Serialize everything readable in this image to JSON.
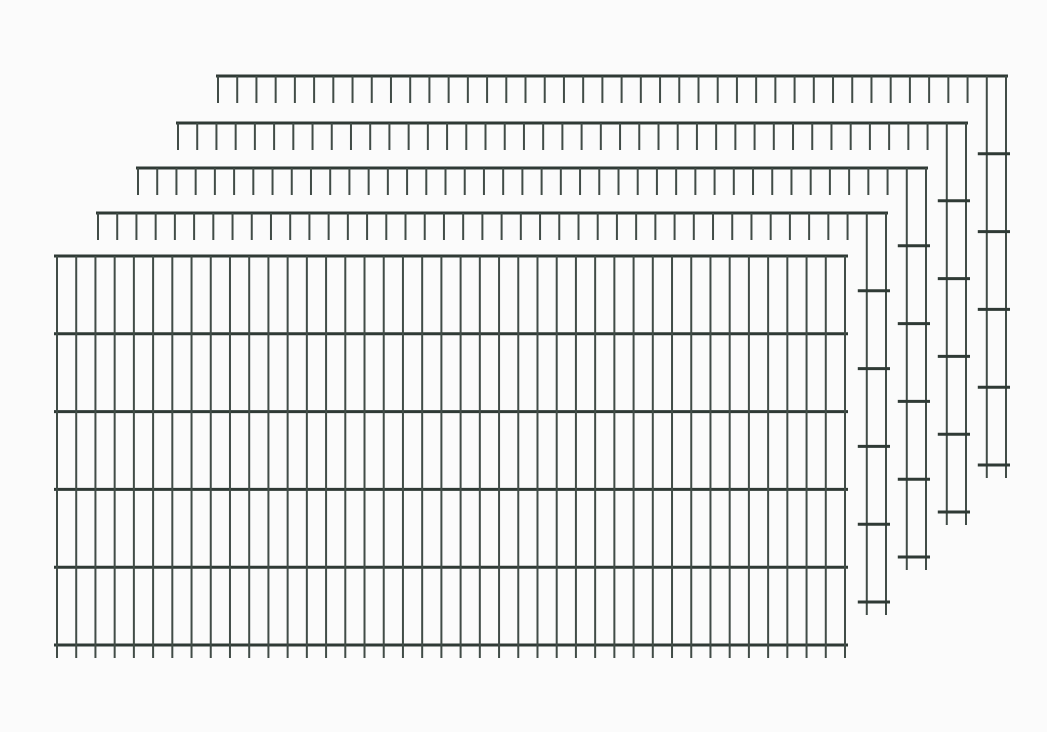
{
  "image_meta": {
    "alt_text": "Product illustration of a set of 5 dark green double-rod wire mesh fence panels stacked behind one another with a diagonal offset on a white background"
  },
  "illustration": {
    "canvas": {
      "width": 1047,
      "height": 732
    },
    "colors": {
      "background": "#fbfbfb",
      "horizontal_wire": "#2f3a35",
      "vertical_wire": "#414c47"
    },
    "geometry": {
      "vertical_spacing": 19.2195,
      "horizontal_spacing": 77.8,
      "horizontal_rows": 6,
      "vertical_wires": 42,
      "top_stub_length": 27,
      "bottom_spike": 13,
      "rail_overhang": 2,
      "front_rail_overhang": 3,
      "rung_overhang_left": 9,
      "rung_overhang_right": 4,
      "horizontal_stroke": 3,
      "vertical_stroke": 2
    },
    "panels": [
      {
        "name": "fence-panel-5",
        "style": "back",
        "left": 218,
        "rail_y": 76,
        "right": 1006
      },
      {
        "name": "fence-panel-4",
        "style": "back",
        "left": 178,
        "rail_y": 123,
        "right": 966
      },
      {
        "name": "fence-panel-3",
        "style": "back",
        "left": 138,
        "rail_y": 168,
        "right": 926
      },
      {
        "name": "fence-panel-2",
        "style": "back",
        "left": 98,
        "rail_y": 213,
        "right": 886
      },
      {
        "name": "fence-panel-1",
        "style": "front",
        "left": 57,
        "rail_y": 256,
        "right": 845
      }
    ]
  }
}
